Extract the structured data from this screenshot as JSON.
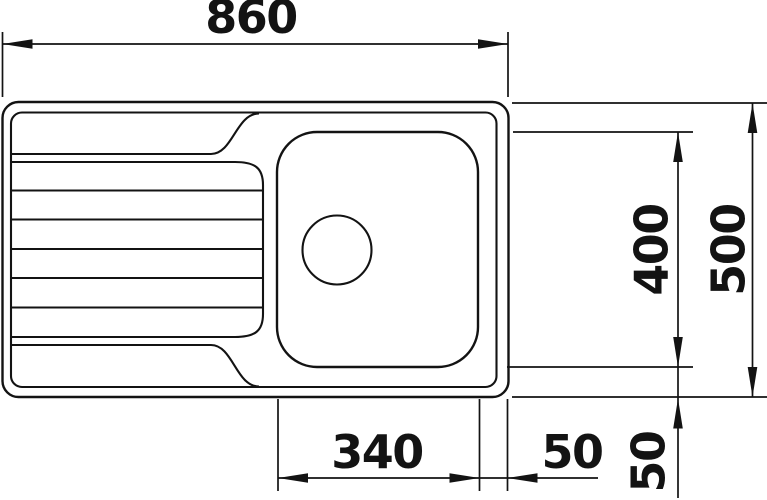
{
  "drawing": {
    "subject_label": "sink-top-view-technical-drawing",
    "colors": {
      "line": "#131313",
      "background": "#ffffff"
    },
    "dims": {
      "total_width": "860",
      "total_depth": "500",
      "basin_depth": "400",
      "basin_width": "340",
      "basin_to_edge_offset": "50",
      "basin_to_bottom_offset": "50"
    }
  }
}
